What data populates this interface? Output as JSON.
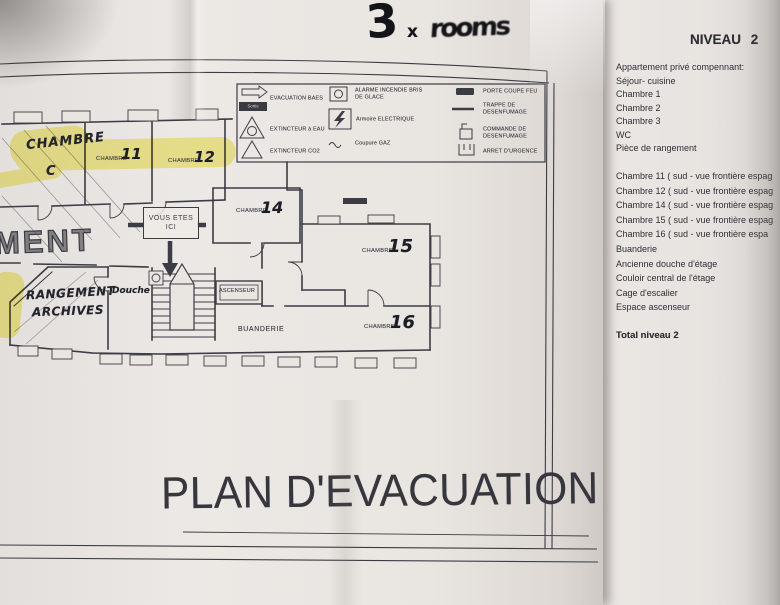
{
  "colors": {
    "ink": "#3c3c44",
    "highlight": "#f3e84b",
    "paper": "#e9e5e1"
  },
  "note_top": {
    "figure": "3",
    "multiplier": "x",
    "word": "rooms"
  },
  "legend": {
    "items": [
      {
        "icon": "evacuation-arrow-icon",
        "label": "EVACUATION BAES",
        "badge": "Sortie"
      },
      {
        "icon": "extinguisher-water-icon",
        "label": "EXTINCTEUR à EAU"
      },
      {
        "icon": "extinguisher-co2-icon",
        "label": "EXTINCTEUR CO2"
      },
      {
        "icon": "break-glass-alarm-icon",
        "label": "ALARME INCENDIE BRIS",
        "label2": "DE GLACE"
      },
      {
        "icon": "electrical-cabinet-icon",
        "label": "Armoire ELECTRIQUE"
      },
      {
        "icon": "gas-cut-icon",
        "label": "Coupure GAZ"
      },
      {
        "icon": "fire-door-icon",
        "label": "PORTE COUPE FEU"
      },
      {
        "icon": "smoke-hatch-icon",
        "label": "TRAPPE DE",
        "label2": "DESENFUMAGE"
      },
      {
        "icon": "smoke-control-icon",
        "label": "COMMANDE DE",
        "label2": "DESENFUMAGE"
      },
      {
        "icon": "emergency-stop-icon",
        "label": "ARRET D'URGENCE"
      }
    ]
  },
  "plan": {
    "title": "PLAN D'EVACUATION",
    "you_are_here": {
      "line1": "VOUS ETES",
      "line2": "ICI"
    },
    "rooms": [
      {
        "id": "chambre-c",
        "handwritten_name": "CHAMBRE",
        "number": "C",
        "highlighted": true
      },
      {
        "id": "chambre-11",
        "printed": "CHAMBRE",
        "number": "11",
        "highlighted": true
      },
      {
        "id": "chambre-12",
        "printed": "CHAMBRE",
        "number": "12",
        "highlighted": true
      },
      {
        "id": "chambre-14",
        "printed": "CHAMBRE",
        "number": "14",
        "highlighted": false
      },
      {
        "id": "chambre-15",
        "printed": "CHAMBRE",
        "number": "15",
        "highlighted": false
      },
      {
        "id": "chambre-16",
        "printed": "CHAMBRE",
        "number": "16",
        "highlighted": false
      }
    ],
    "areas": {
      "ascenseur": "ASCENSEUR",
      "buanderie": "BUANDERIE",
      "rangement_line1": "RANGEMENT",
      "rangement_line2": "ARCHIVES",
      "douche": "Douche",
      "ment_fragment": "MENT"
    }
  },
  "info_sheet": {
    "title": "NIVEAU 2",
    "block1": [
      "Appartement privé compennant:",
      "Séjour- cuisine",
      "Chambre 1",
      "Chambre 2",
      "Chambre 3",
      "WC",
      "Pièce de rangement"
    ],
    "block2": [
      "Chambre 11 ( sud - vue frontière espag",
      "Chambre 12 ( sud - vue frontière espag",
      "Chambre 14 ( sud - vue frontière espag",
      "Chambre 15 ( sud - vue frontière espag",
      "Chambre 16 ( sud - vue frontière espa",
      "Buanderie",
      "Ancienne douche d'étage",
      "Couloir central de l'étage",
      "Cage d'escalier",
      "Espace ascenseur"
    ],
    "total_label": "Total niveau 2"
  }
}
